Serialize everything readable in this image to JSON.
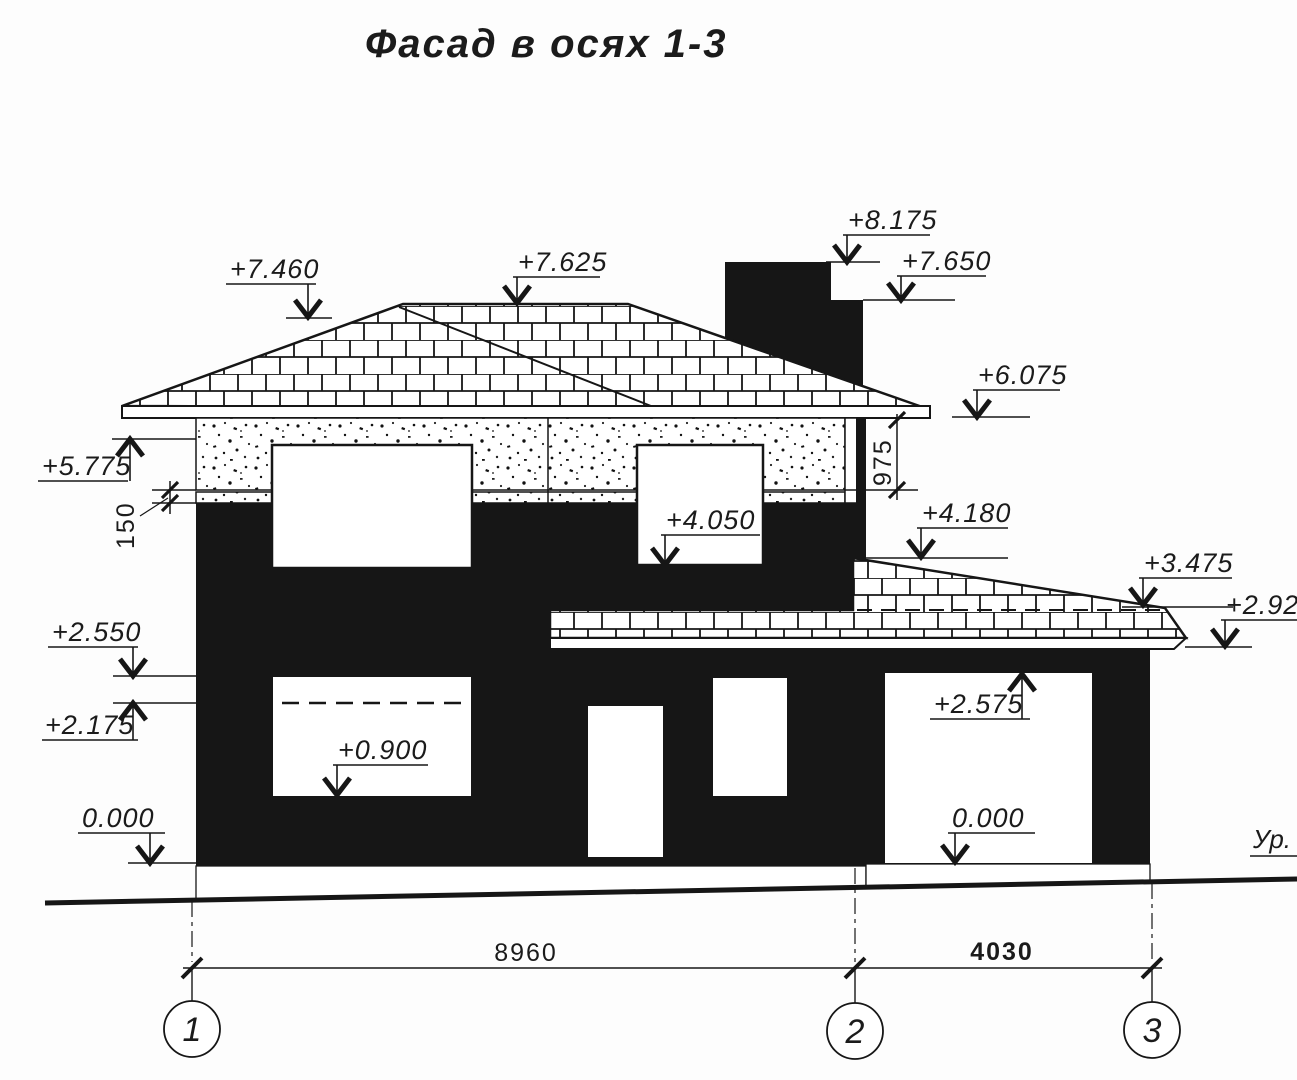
{
  "title": "Фасад в осях 1-3",
  "marks": {
    "m7460": "+7.460",
    "m7625": "+7.625",
    "m8175": "+8.175",
    "m7650": "+7.650",
    "m6075": "+6.075",
    "m5775": "+5.775",
    "m4180": "+4.180",
    "m4050": "+4.050",
    "m3475": "+3.475",
    "m2925": "+2.925",
    "m2575": "+2.575",
    "m2550": "+2.550",
    "m2175": "+2.175",
    "m0900": "+0.900",
    "zero_left": "0.000",
    "zero_right": "0.000"
  },
  "dims": {
    "band": "150",
    "eaves": "975",
    "span12": "8960",
    "span23": "4030"
  },
  "axes": {
    "a1": "1",
    "a2": "2",
    "a3": "3"
  },
  "ground_level_label": "Ур. з",
  "colors": {
    "ink": "#161616",
    "paper": "#fdfdfd"
  }
}
